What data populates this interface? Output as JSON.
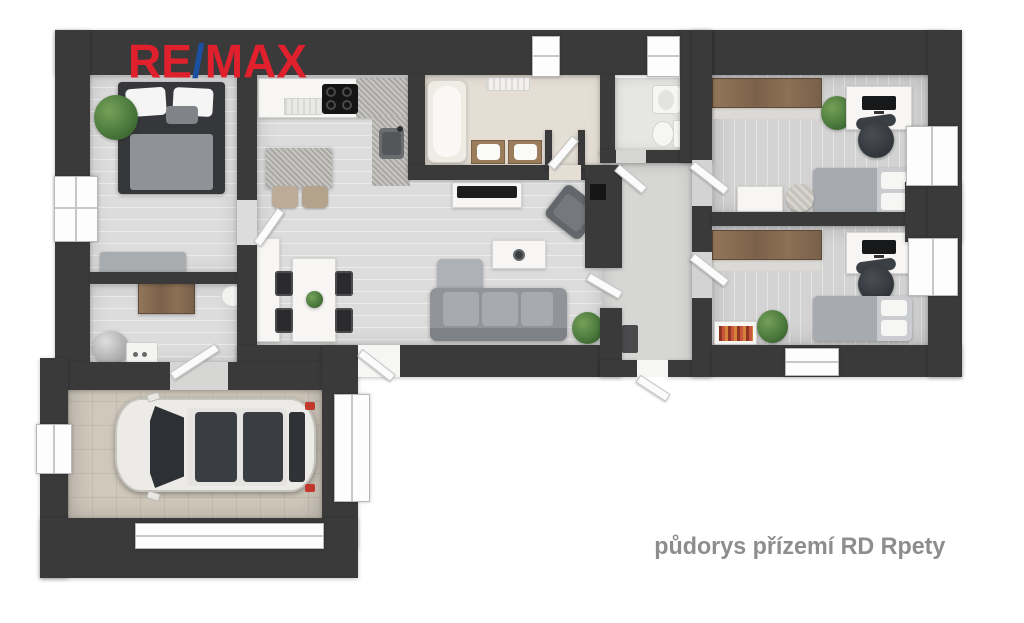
{
  "logo": {
    "re": "RE",
    "slash": "/",
    "max": "MAX",
    "red": "#e0202c",
    "blue": "#1b4fa0"
  },
  "caption": {
    "text": "půdorys přízemí RD Rpety",
    "color": "#8d8d8d"
  },
  "palette": {
    "wall": "#3a3a3a",
    "floor_living": "#dcdcdc",
    "floor_rooms": "#d3d3d3",
    "floor_bathroom": "#e4ded4",
    "floor_wc": "#e6e6e3",
    "floor_hallway": "#d6d6d4",
    "floor_garage": "#cfc8bb",
    "wood": "#8a6e52",
    "sofa_gray": "#9fa3a8",
    "plant_green": "#4c7a3d",
    "car_body": "#edebe7",
    "taillight_red": "#c0392b",
    "books_red": "#b7432e"
  },
  "rooms": [
    {
      "name": "bedroom",
      "items": [
        "double-bed",
        "pillows",
        "plant",
        "bench",
        "window"
      ]
    },
    {
      "name": "utility-hall",
      "items": [
        "wood-desk",
        "chair",
        "water-heater",
        "washing-machine"
      ]
    },
    {
      "name": "open-plan-kitchen-living",
      "items": [
        "kitchen-counter",
        "cooktop",
        "kitchen-sink",
        "island",
        "bar-stools",
        "tall-cabinet",
        "dining-table",
        "dining-chairs",
        "tv-bench",
        "tv",
        "coffee-table",
        "armchair",
        "corner-sofa",
        "plants",
        "fireplace-niche"
      ]
    },
    {
      "name": "bathroom",
      "items": [
        "bathtub",
        "double-vanity",
        "radiator"
      ]
    },
    {
      "name": "wc",
      "items": [
        "toilet",
        "washbasin",
        "window"
      ]
    },
    {
      "name": "entrance-hallway",
      "items": [
        "entrance-door",
        "shoe-cabinet",
        "interior-doors"
      ]
    },
    {
      "name": "study-bedroom-1",
      "items": [
        "wardrobe",
        "desk",
        "monitor",
        "office-chair",
        "single-bed",
        "nightstand",
        "pouf",
        "plant",
        "window"
      ]
    },
    {
      "name": "study-bedroom-2",
      "items": [
        "wardrobe",
        "desk",
        "monitor",
        "office-chair",
        "single-bed",
        "bookshelf",
        "plant",
        "window"
      ]
    },
    {
      "name": "garage",
      "items": [
        "car",
        "garage-door",
        "side-window"
      ]
    }
  ]
}
